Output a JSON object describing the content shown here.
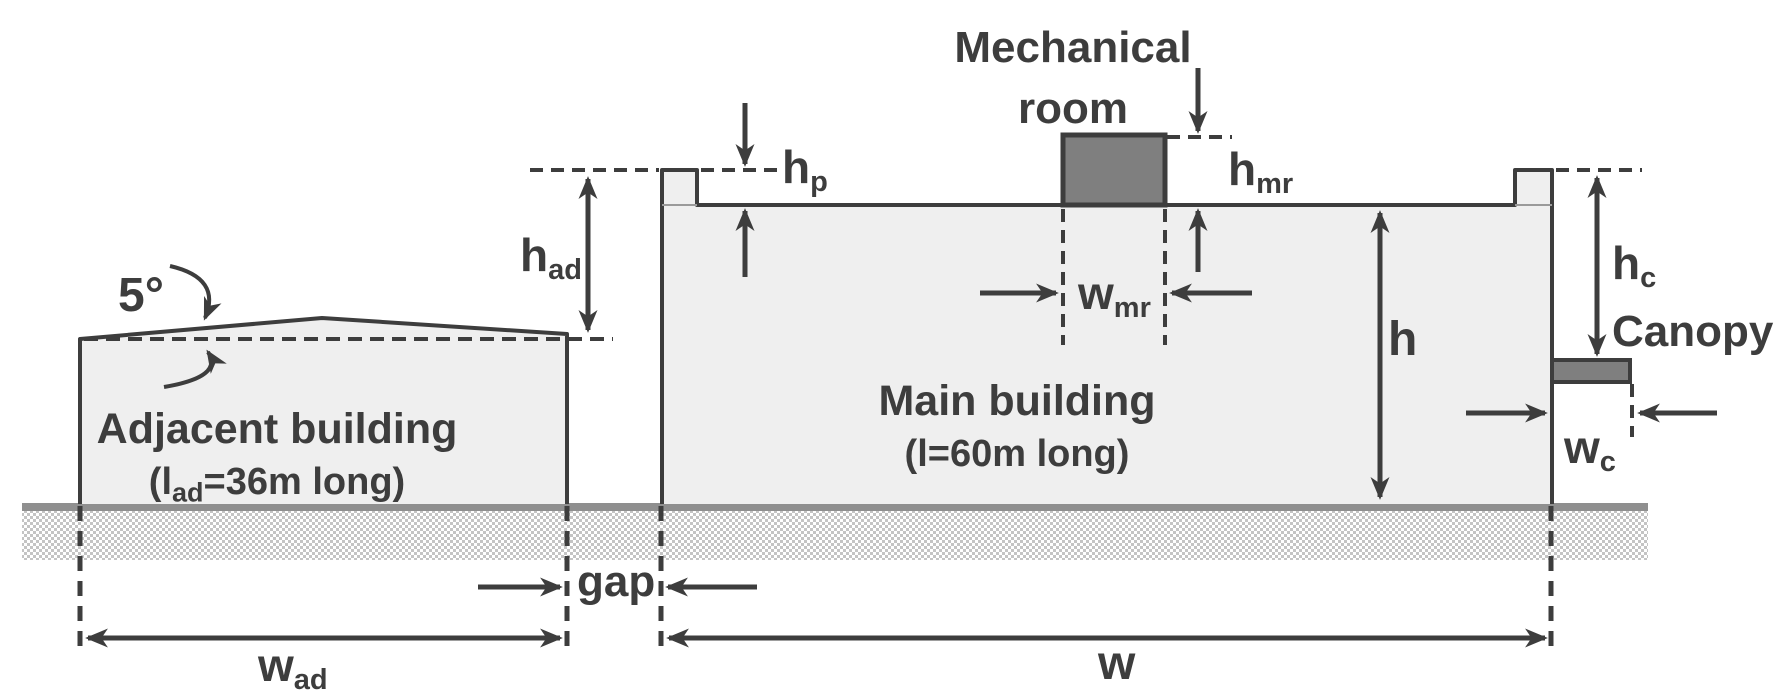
{
  "diagram_title": "Building cross-section with adjacent building, main building, mechanical room and canopy",
  "labels": {
    "mechanical_room_line1": "Mechanical",
    "mechanical_room_line2": "room",
    "roof_angle": "5°",
    "h_ad": {
      "base": "h",
      "sub": "ad"
    },
    "h_p": {
      "base": "h",
      "sub": "p"
    },
    "h_mr": {
      "base": "h",
      "sub": "mr"
    },
    "w_mr": {
      "base": "w",
      "sub": "mr"
    },
    "h": "h",
    "h_c": {
      "base": "h",
      "sub": "c"
    },
    "canopy": "Canopy",
    "w_c": {
      "base": "w",
      "sub": "c"
    },
    "gap": "gap",
    "w_ad": {
      "base": "w",
      "sub": "ad"
    },
    "w": "w",
    "adjacent": {
      "name": "Adjacent building",
      "size_pre": "(l",
      "size_sub": "ad",
      "size_post": "=36m long)"
    },
    "main": {
      "name": "Main building",
      "size": "(l=60m long)"
    }
  },
  "values": {
    "adjacent_building_length": "36m",
    "main_building_length": "60m",
    "roof_slope_deg": "5°"
  },
  "colors": {
    "ink": "#3d3d3d",
    "building_fill": "#efefef",
    "dark_fill": "#7f7f7f",
    "ground_band": "#8f8f8f",
    "ground_hatch": "#c4c4c4"
  }
}
